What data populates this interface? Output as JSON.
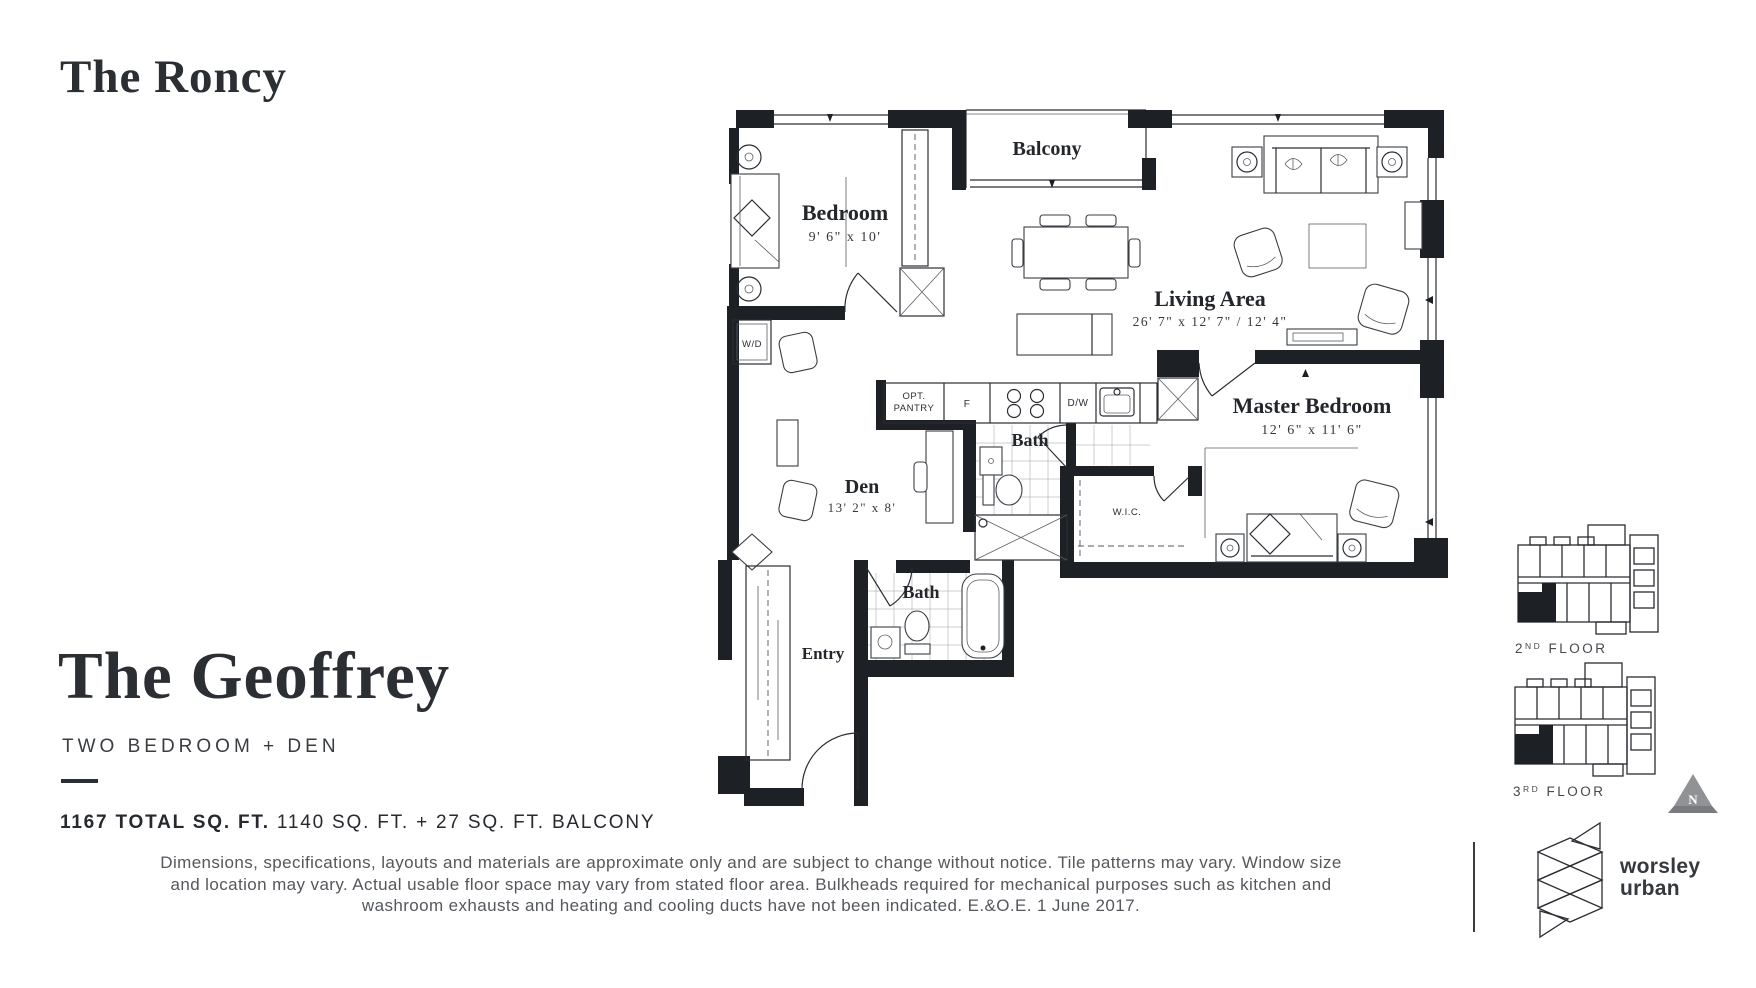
{
  "header": {
    "building": "The Roncy"
  },
  "unit": {
    "name": "The Geoffrey",
    "type": "TWO BEDROOM + DEN",
    "area_total": "1167 TOTAL SQ. FT.",
    "area_breakdown": " 1140 SQ. FT. + 27 SQ. FT. BALCONY"
  },
  "disclaimer": {
    "line1": "Dimensions, specifications, layouts and materials are approximate only and are subject to change without notice. Tile patterns may vary. Window size",
    "line2": "and location may vary. Actual usable floor space may vary from stated floor area. Bulkheads required for mechanical purposes such as kitchen and",
    "line3": "washroom exhausts and heating and cooling ducts have not been indicated. E.&O.E. 1 June 2017."
  },
  "floorplan": {
    "balcony": "Balcony",
    "bedroom": {
      "name": "Bedroom",
      "dims": "9' 6\" x 10'"
    },
    "living": {
      "name": "Living Area",
      "dims": "26' 7\" x 12' 7\" / 12' 4\""
    },
    "master": {
      "name": "Master Bedroom",
      "dims": "12' 6\" x 11' 6\""
    },
    "den": {
      "name": "Den",
      "dims": "13' 2\" x 8'"
    },
    "bath1": "Bath",
    "bath2": "Bath",
    "entry": "Entry",
    "wd": "W/D",
    "pantry_line1": "OPT.",
    "pantry_line2": "PANTRY",
    "fridge": "F",
    "dishwasher": "D/W",
    "wic": "W.I.C."
  },
  "keyplans": {
    "floor2": {
      "num": "2",
      "ord": "ND",
      "word": " FLOOR"
    },
    "floor3": {
      "num": "3",
      "ord": "RD",
      "word": " FLOOR"
    }
  },
  "compass": {
    "label": "N"
  },
  "logo": {
    "line1": "worsley",
    "line2": "urban"
  }
}
